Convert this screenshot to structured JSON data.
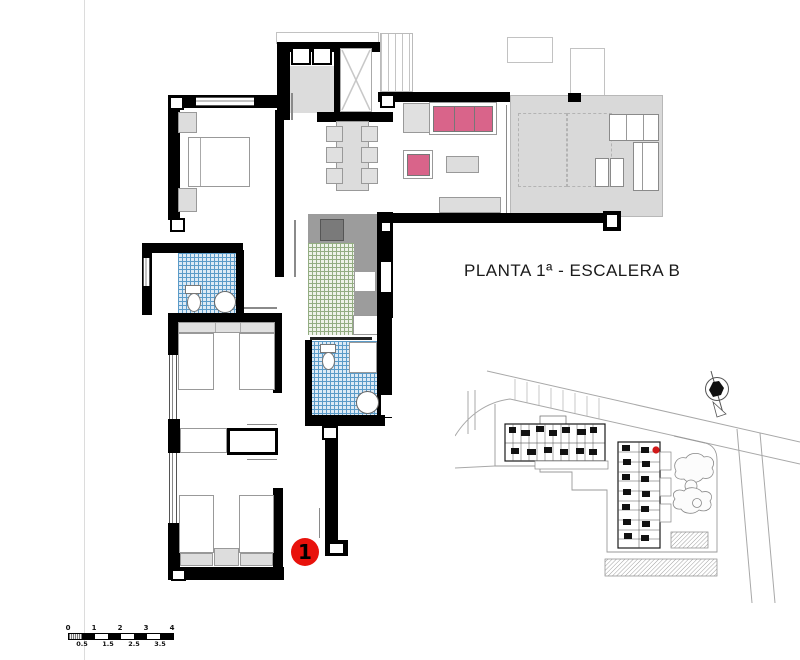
{
  "title": "PLANTA 1ª - ESCALERA B",
  "marker": {
    "label": "1"
  },
  "scale_bar": {
    "top_labels": [
      "0",
      "1",
      "2",
      "3",
      "4"
    ],
    "bottom_labels": [
      "0.5",
      "1.5",
      "2.5",
      "3.5"
    ]
  },
  "colors": {
    "wall-black": "#000000",
    "sofa-pink": "#d9648a",
    "tile-blue-line": "#5b9bc8",
    "tile-blue-bg": "#ddeaf5",
    "tile-green-line": "#93ad82",
    "tile-green-bg": "#eef2e9",
    "terrace-gray": "#d9d9d9",
    "counter-gray": "#9c9c9c",
    "appliance-gray": "#7a7a7a",
    "landing-gray": "#dcdcdc",
    "furniture-gray": "#e0e0e0",
    "marker-red": "#e8120c",
    "site-marker-red": "#d01818"
  }
}
